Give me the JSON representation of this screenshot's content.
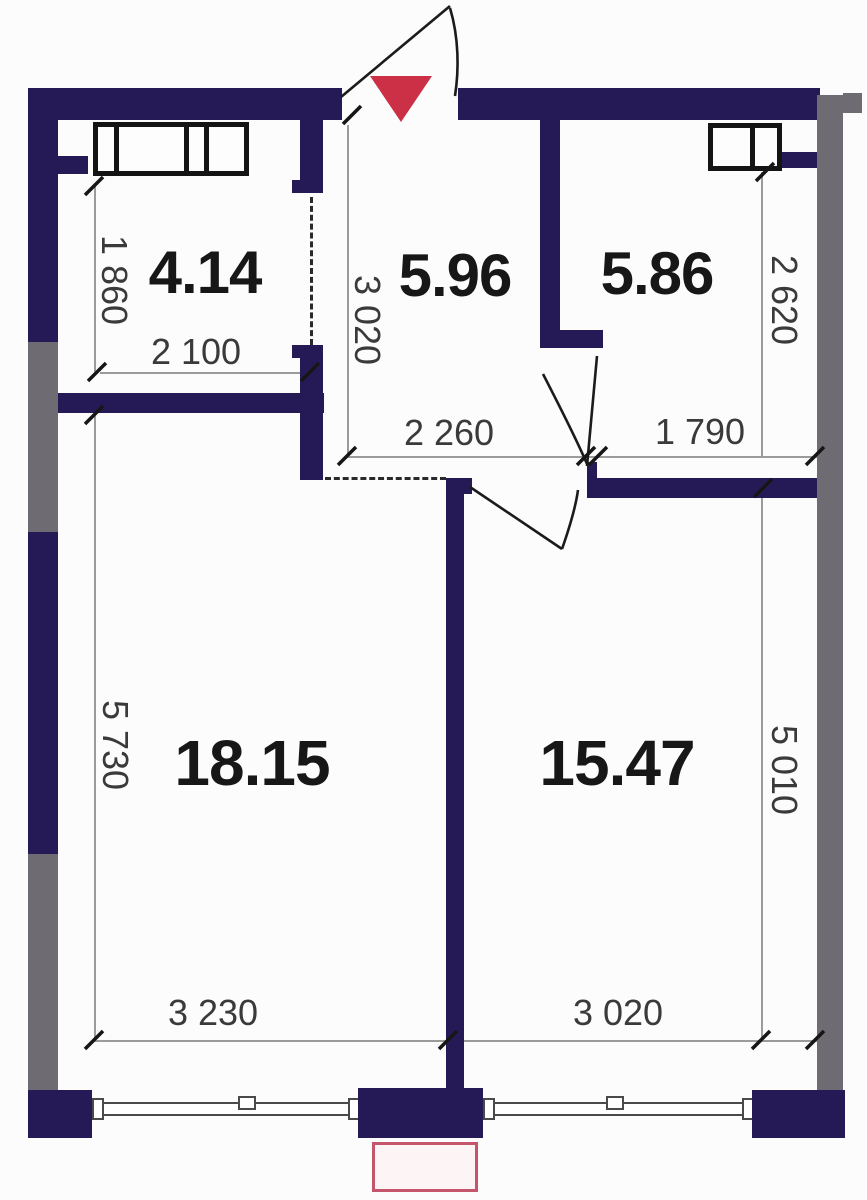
{
  "plan": {
    "type": "apartment-floor-plan",
    "rooms": [
      {
        "name": "top-left-room",
        "area": "4.14"
      },
      {
        "name": "hallway",
        "area": "5.96"
      },
      {
        "name": "top-right-room",
        "area": "5.86"
      },
      {
        "name": "bottom-left-room",
        "area": "18.15"
      },
      {
        "name": "bottom-right-room",
        "area": "15.47"
      }
    ],
    "dimensions": {
      "room_414_height": "1 860",
      "room_414_width": "2 100",
      "hallway_height": "3 020",
      "hallway_width": "2 260",
      "room_586_width": "1 790",
      "room_586_height": "2 620",
      "room_1815_height": "5 730",
      "room_1815_width": "3 230",
      "room_1547_height": "5 010",
      "room_1547_width": "3 020"
    },
    "colors": {
      "wall": "#261a56",
      "shared_wall": "#6f6b72",
      "entrance_marker": "#cb3046",
      "dimension_line": "#9b9b9b",
      "text": "#3a3a3a",
      "accent_box_border": "#c4566b",
      "accent_box_fill": "#fdf4f5"
    }
  }
}
